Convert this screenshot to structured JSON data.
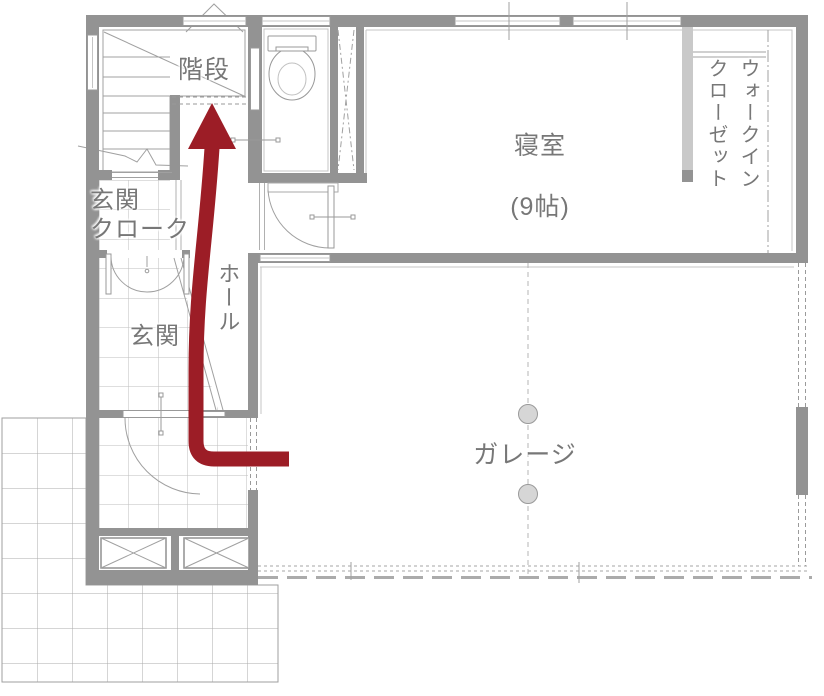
{
  "colors": {
    "wall-color": "#939393",
    "arrow-color": "#9c1d26",
    "text-color": "#777777"
  },
  "plan": {
    "rooms": {
      "stairs": {
        "label": "階段"
      },
      "bedroom": {
        "label": "寝室",
        "size": "(9帖)"
      },
      "walk_in_closet": {
        "label": "ウォークイン\nクローゼット"
      },
      "entrance_cloak": {
        "label": "玄関\nクローク"
      },
      "hall": {
        "label": "ホール"
      },
      "entrance": {
        "label": "玄関"
      },
      "garage": {
        "label": "ガレージ"
      }
    }
  }
}
